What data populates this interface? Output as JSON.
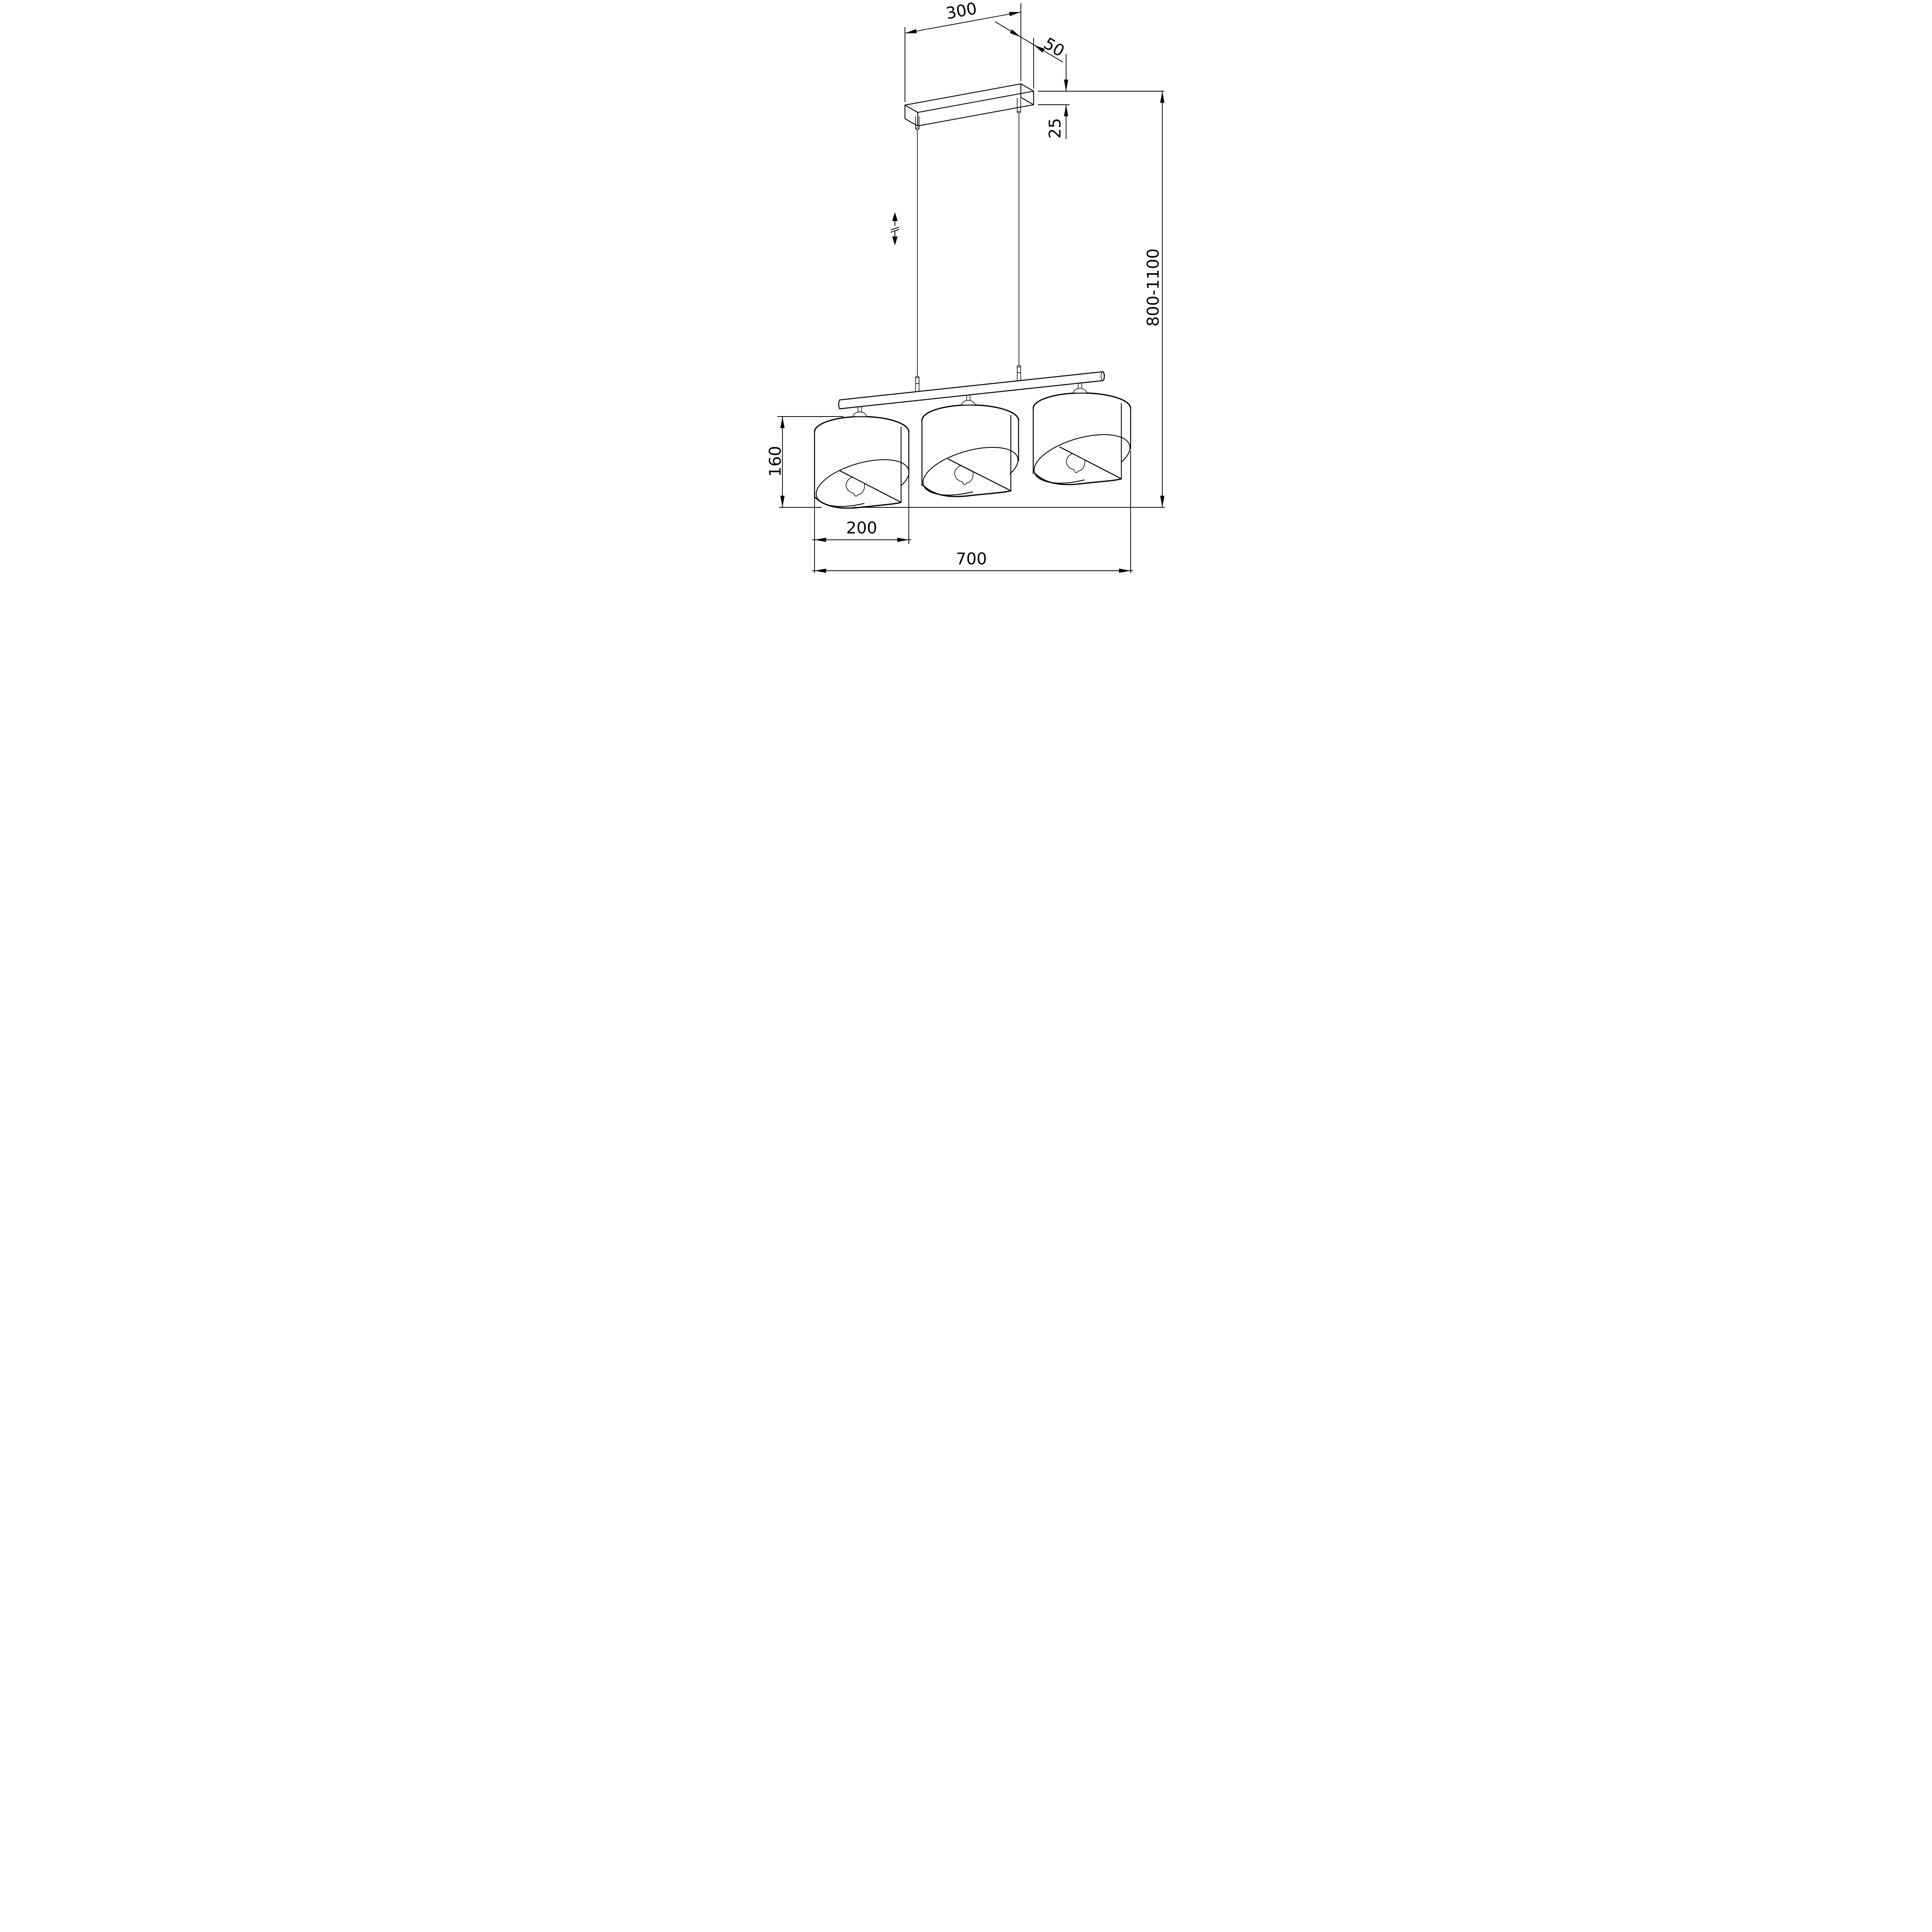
{
  "drawing": {
    "type": "technical-dimension-drawing",
    "subject": "three-shade linear pendant lamp with ceiling canopy and adjustable suspension",
    "colors": {
      "background": "#ffffff",
      "line": "#000000"
    },
    "dimensions": {
      "canopy_length": "300",
      "canopy_depth": "50",
      "canopy_thickness": "25",
      "shade_height": "160",
      "shade_diameter": "200",
      "fixture_width": "700",
      "suspension_height_range": "800-1100"
    }
  }
}
